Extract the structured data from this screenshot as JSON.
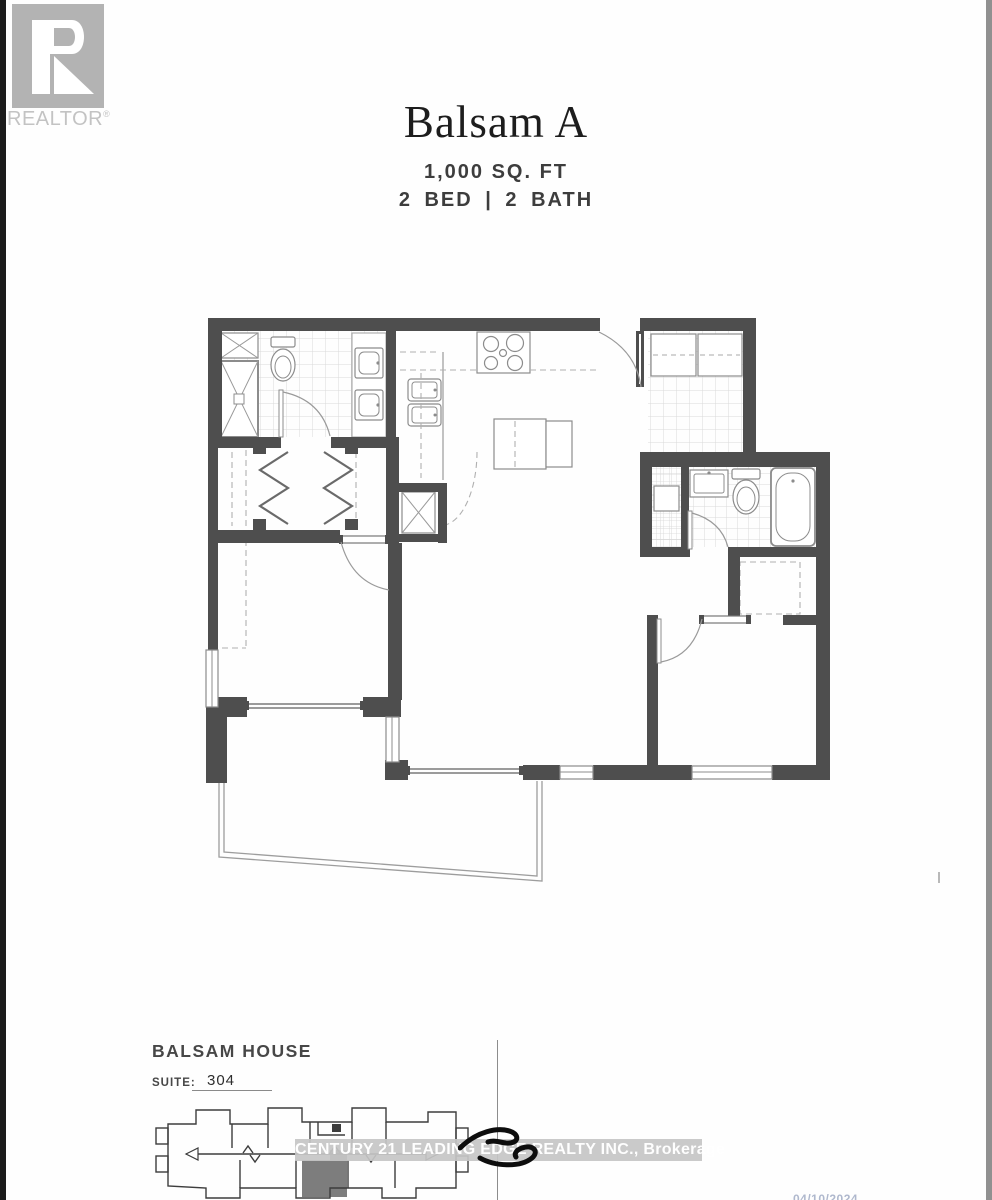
{
  "branding": {
    "realtor_text": "REALTOR",
    "registered_mark": "®"
  },
  "header": {
    "title": "Balsam A",
    "area": "1,000 SQ. FT",
    "bed_bath": "2 BED | 2 BATH"
  },
  "footer": {
    "building_name": "BALSAM HOUSE",
    "suite_label": "SUITE:",
    "suite_number": "304",
    "watermark": "CENTURY 21 LEADING EDGE REALTY INC., Brokerage",
    "date_stamp": "04/10/2024"
  },
  "colors": {
    "wall": "#4e4e4e",
    "tile_line": "#dadada",
    "fixture_line": "#8c8c8c",
    "logo_gray": "#b3b3b3",
    "highlighted_unit": "#7d7d7d",
    "watermark_band": "#c6c6c6"
  }
}
